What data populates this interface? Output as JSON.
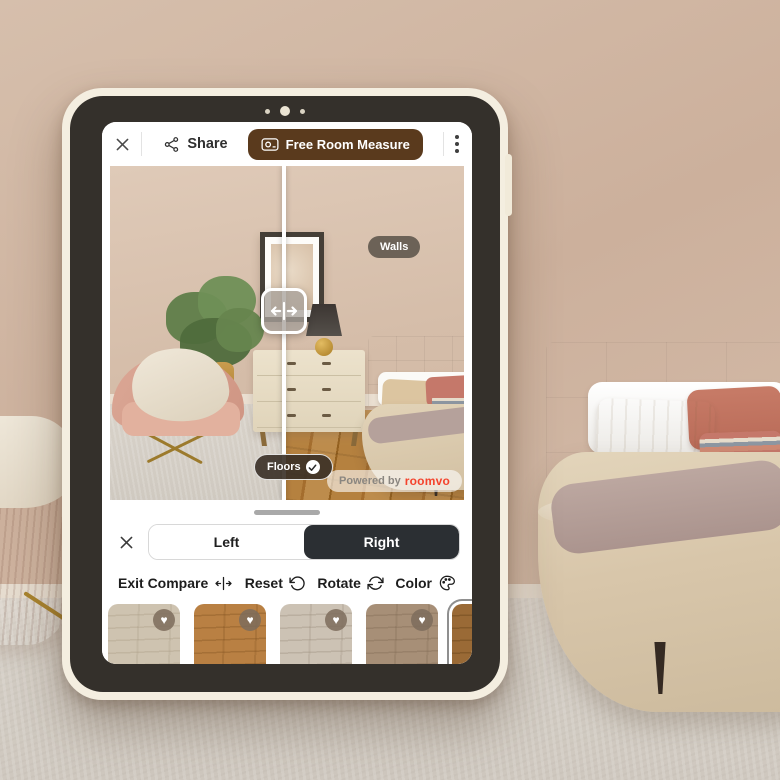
{
  "device": {
    "name": "tablet-mockup"
  },
  "topbar": {
    "share_label": "Share",
    "measure_label": "Free Room Measure"
  },
  "viewer": {
    "walls_tag": "Walls",
    "floors_tag": "Floors",
    "watermark_prefix": "Powered by",
    "watermark_brand": "roomvo"
  },
  "sheet": {
    "toggle": {
      "left": "Left",
      "right": "Right",
      "selected": "Right"
    },
    "tools": [
      {
        "label": "Exit Compare",
        "icon": "compare-arrows-icon"
      },
      {
        "label": "Reset",
        "icon": "rotate-ccw-icon"
      },
      {
        "label": "Rotate",
        "icon": "rotate-cw-icon"
      },
      {
        "label": "Color",
        "icon": "palette-icon"
      }
    ],
    "swatches": [
      {
        "name": "light-cream-wood",
        "color": "#cec3b0",
        "grain": "#a89a83",
        "favorite": true,
        "selected": false
      },
      {
        "name": "warm-oak-wood",
        "color": "#b98043",
        "grain": "#7e4f1d",
        "favorite": true,
        "selected": false
      },
      {
        "name": "light-grey-wood",
        "color": "#ccc2b4",
        "grain": "#998c7a",
        "favorite": true,
        "selected": false
      },
      {
        "name": "taupe-wood",
        "color": "#a78f77",
        "grain": "#7c6650",
        "favorite": true,
        "selected": false
      },
      {
        "name": "rustic-brown-wood",
        "color": "#9a6a36",
        "grain": "#5d3a12",
        "favorite": false,
        "selected": true
      }
    ]
  },
  "colors": {
    "accent_brown": "#5a3a1d",
    "toggle_dark": "#2b2f33",
    "brand_red": "#f4432c"
  }
}
